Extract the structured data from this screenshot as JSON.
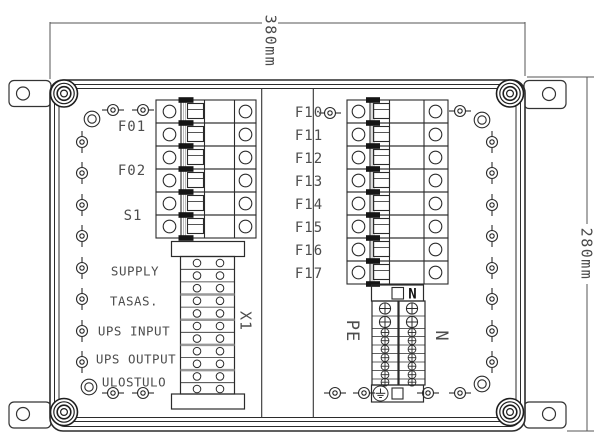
{
  "dimensions": {
    "width": "380mm",
    "height": "280mm"
  },
  "left_breaker_labels": [
    "F01",
    "F02",
    "S1"
  ],
  "right_breaker_labels": [
    "F10",
    "F11",
    "F12",
    "F13",
    "F14",
    "F15",
    "F16",
    "F17"
  ],
  "terminal_strip_label": "X1",
  "busbars": {
    "pe_label": "PE",
    "n_label": "N",
    "n_box_label": "N"
  },
  "zone_labels": {
    "supply": "SUPPLY",
    "tasas": "TASAS.",
    "ups_input": "UPS INPUT",
    "ups_output": "UPS OUTPUT",
    "ulostulo": "ULOSTULO"
  },
  "colors": {
    "line": "#2b2b2b",
    "light_line": "#999999",
    "text": "#4d4d4d",
    "toggle_black": "#151515"
  }
}
